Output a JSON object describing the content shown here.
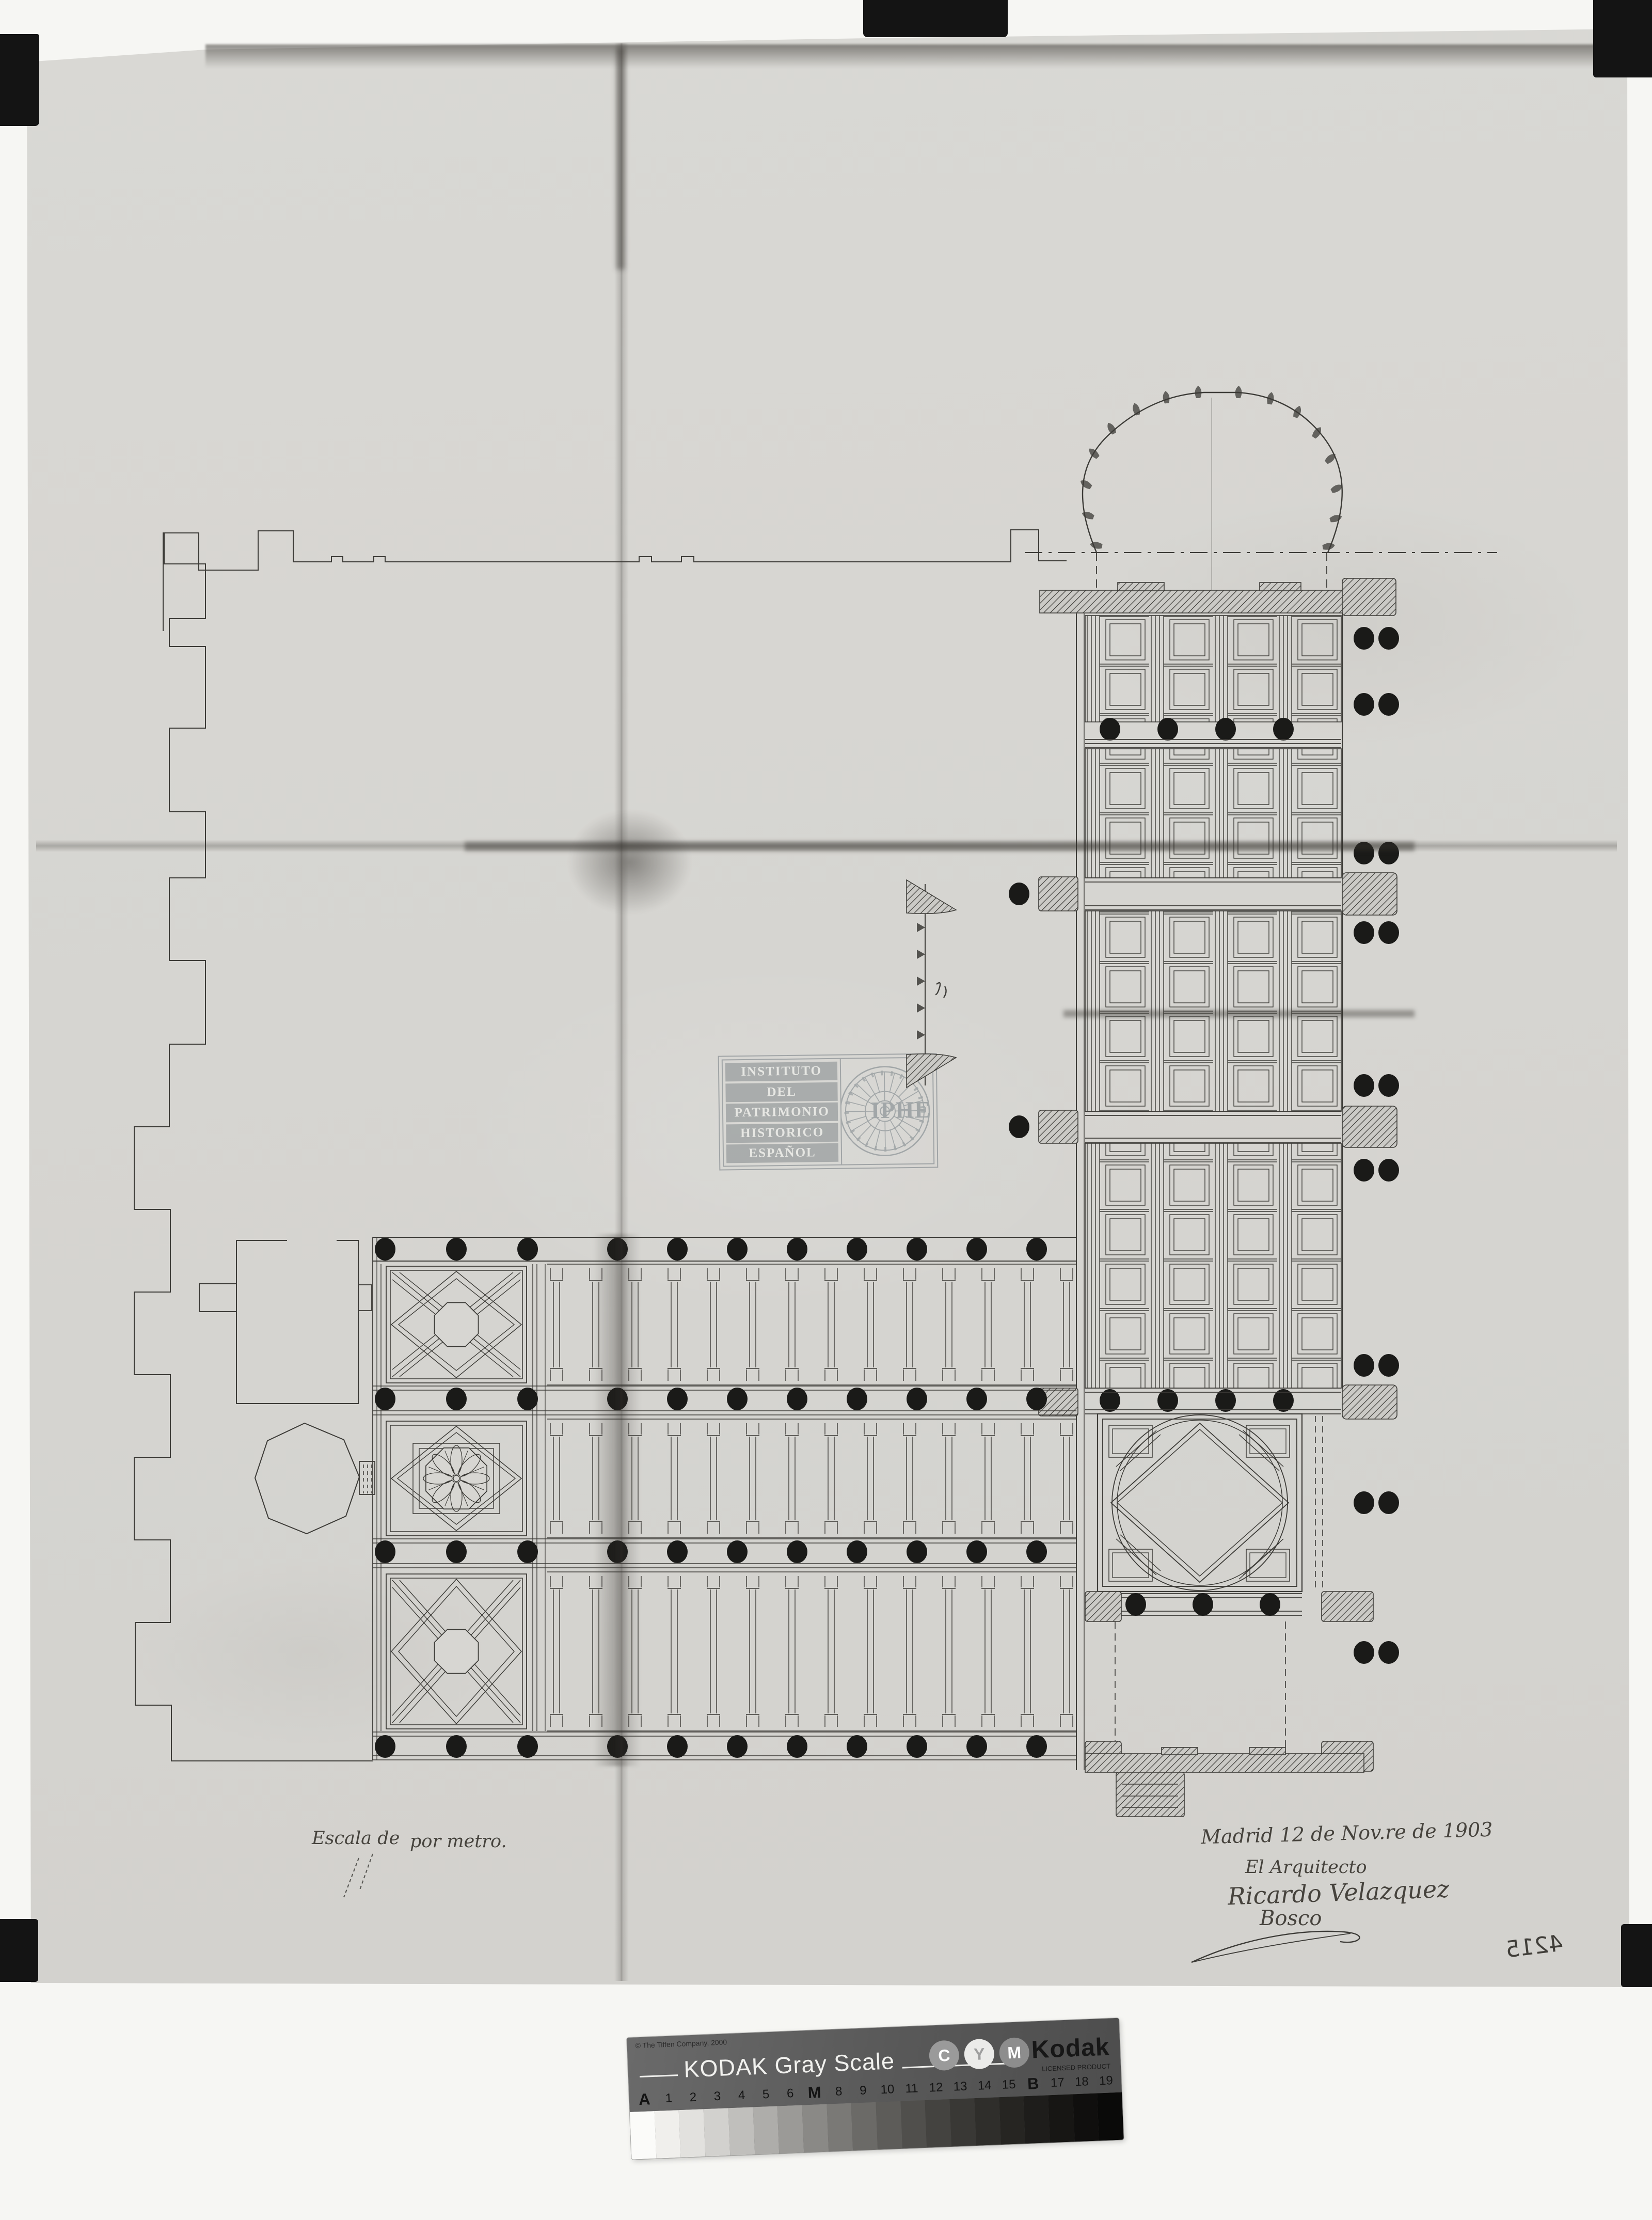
{
  "colors": {
    "scanner_bed": "#f6f6f3",
    "paper": "#d7d6d2",
    "ink": "#3c3b37",
    "column_dot": "#1a1a18",
    "stamp": "#999ea0",
    "kodak_card": "#5d5d5d"
  },
  "stamp": {
    "lines": [
      "INSTITUTO",
      "DEL",
      "PATRIMONIO",
      "HISTORICO",
      "ESPAÑOL"
    ],
    "acronym": "IPHE"
  },
  "annotations": {
    "scale_label_left": "Escala de",
    "scale_label_right": "por metro.",
    "date_line": "Madrid 12 de Nov.re de 1903",
    "architect_title": "El Arquitecto",
    "signature_name": "Ricardo Velazquez",
    "signature_surname": "Bosco",
    "inventory_number": "4215"
  },
  "kodak_bar": {
    "copyright": "© The Tiffen Company, 2000",
    "title": "KODAK Gray Scale",
    "cmy_badges": [
      "C",
      "Y",
      "M"
    ],
    "brand": "Kodak",
    "brand_subtitle": "LICENSED PRODUCT",
    "scale_labels": [
      "A",
      "1",
      "2",
      "3",
      "4",
      "5",
      "6",
      "M",
      "8",
      "9",
      "10",
      "11",
      "12",
      "13",
      "14",
      "15",
      "B",
      "17",
      "18",
      "19"
    ],
    "major_labels": [
      "A",
      "M",
      "B"
    ],
    "patch_colors": [
      "#fbfbf9",
      "#f0efec",
      "#e2e1de",
      "#d2d1ce",
      "#c0bfbc",
      "#aeadaa",
      "#9b9a97",
      "#8a8986",
      "#7a7976",
      "#6b6a67",
      "#5d5c59",
      "#504f4c",
      "#444340",
      "#393835",
      "#2f2e2b",
      "#262522",
      "#1e1d1b",
      "#171614",
      "#100f0e",
      "#0a0a09"
    ]
  }
}
